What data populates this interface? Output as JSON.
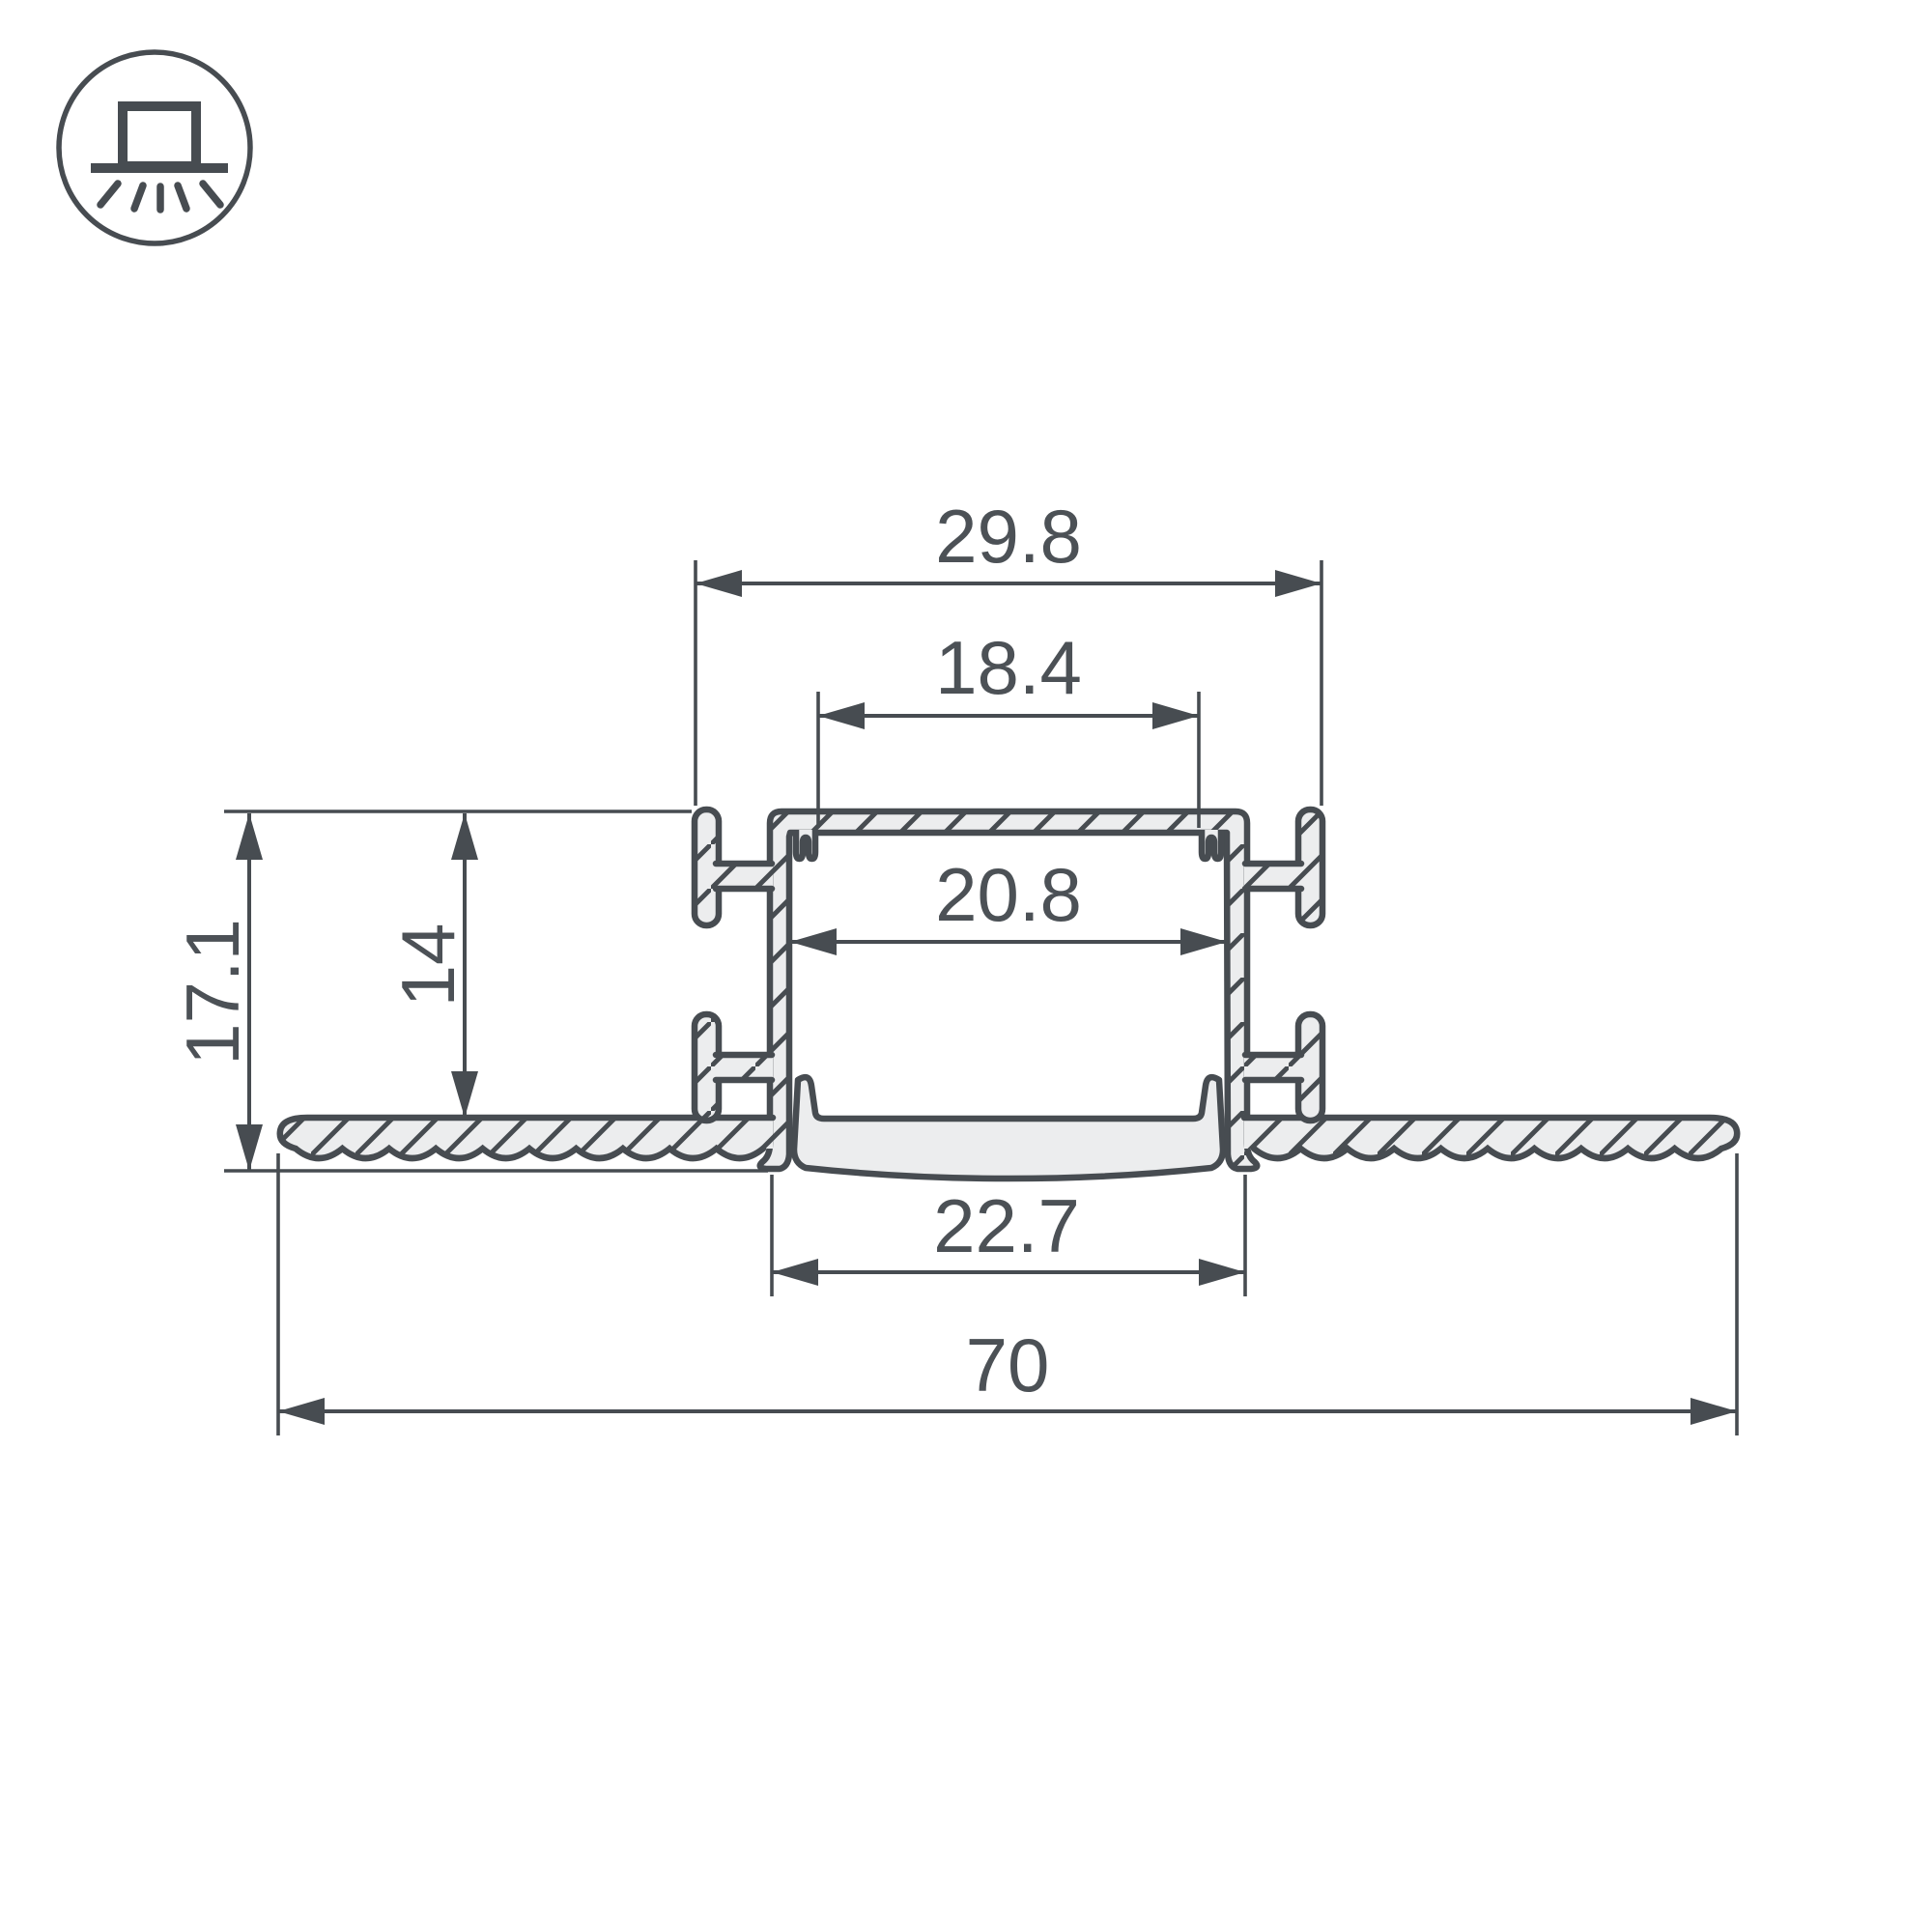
{
  "icon": {
    "name": "recessed-mount-light-icon",
    "meaning": "recessed ceiling mounting"
  },
  "drawing": {
    "type": "profile-cross-section",
    "dimensions": {
      "outer_tab_width": "29.8",
      "led_slot_width": "18.4",
      "inner_channel_width": "20.8",
      "recess_depth": "14",
      "overall_height": "17.1",
      "bottom_lip_width": "22.7",
      "overall_flange_width": "70"
    }
  },
  "colors": {
    "line": "#474c51",
    "fill": "#ecedee",
    "text": "#4c5156",
    "background": "#ffffff"
  }
}
